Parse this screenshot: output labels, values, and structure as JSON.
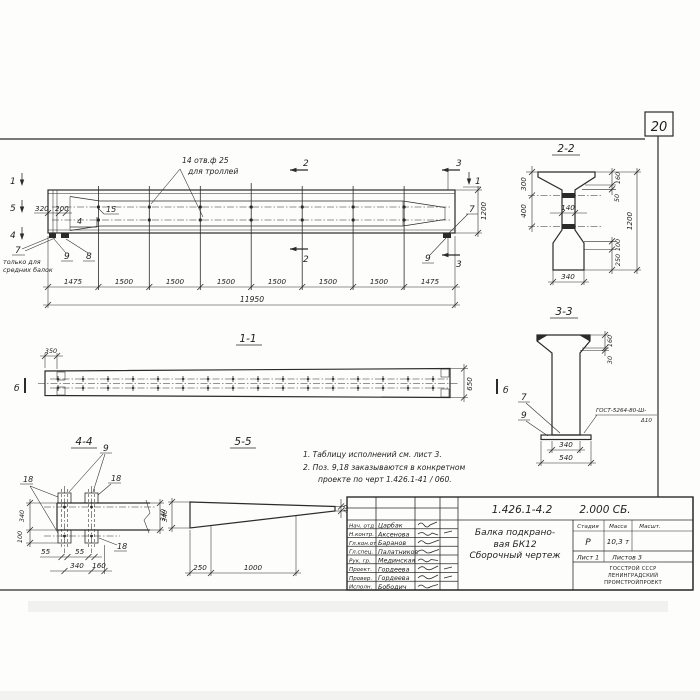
{
  "sheet": {
    "num": "20"
  },
  "elevation": {
    "note1": "14 отв.ф 25",
    "note2": "для троллей",
    "m1": "1",
    "m5": "5",
    "m4": "4",
    "m2": "2",
    "m3": "3",
    "d320": "320",
    "d200": "200",
    "p15": "15",
    "p7": "7",
    "p7n1": "только для",
    "p7n2": "средних балок",
    "p8": "8",
    "p9": "9",
    "d1200": "1200",
    "dims": [
      "1475",
      "1500",
      "1500",
      "1500",
      "1500",
      "1500",
      "1500",
      "1475"
    ],
    "total": "11950"
  },
  "s22": {
    "title": "2-2",
    "d300": "300",
    "d400": "400",
    "d140": "140",
    "d160": "160",
    "d50": "50",
    "d1200": "1200",
    "d100": "100",
    "d250": "250",
    "d340": "340"
  },
  "s33": {
    "title": "3-3",
    "d160": "160",
    "d30": "30",
    "p7": "7",
    "p9": "9",
    "weld1": "ГОСТ-5264-80-Ш-",
    "weld2": "Δ10",
    "d340": "340",
    "d540": "540"
  },
  "s11": {
    "title": "1-1",
    "d350": "350",
    "d650": "650",
    "mb": "б"
  },
  "s44": {
    "title": "4-4",
    "p9": "9",
    "p18": "18",
    "d340": "340",
    "d100": "100",
    "d55": "55",
    "d160": "160"
  },
  "s55": {
    "title": "5-5",
    "d340": "340",
    "d250": "250",
    "d1000": "1000",
    "d40": "40"
  },
  "notes": {
    "l1": "1. Таблицу исполнений см. лист 3.",
    "l2": "2. Поз. 9,18 заказываются в конкретном",
    "l3": "проекте по черт 1.426.1-41 / 060."
  },
  "tb": {
    "doc": "1.426.1-4.2",
    "code": "2.000 СБ.",
    "t1": "Балка подкрано-",
    "t2": "вая БК12",
    "t3": "Сборочный чертеж",
    "h_stage": "Стадия",
    "h_mass": "Масса",
    "h_scale": "Масшт.",
    "stage": "Р",
    "mass": "10,3 т",
    "sheet": "Лист 1",
    "sheets": "Листов 3",
    "org1": "ГОССТРОЙ СССР",
    "org2": "ЛЕНИНГРАДСКИЙ",
    "org3": "ПРОМСТРОЙПРОЕКТ",
    "rows": [
      {
        "role": "Нач. отд",
        "name": "Царбак"
      },
      {
        "role": "Н.контр.",
        "name": "Аксенова"
      },
      {
        "role": "Гл.кон.от",
        "name": "Баранов"
      },
      {
        "role": "Гл.спец.",
        "name": "Палатников"
      },
      {
        "role": "Рук. гр.",
        "name": "Мединская"
      },
      {
        "role": "Проект.",
        "name": "Гордеева"
      },
      {
        "role": "Провер.",
        "name": "Гордеева"
      },
      {
        "role": "Исполн.",
        "name": "Бободич"
      }
    ]
  }
}
